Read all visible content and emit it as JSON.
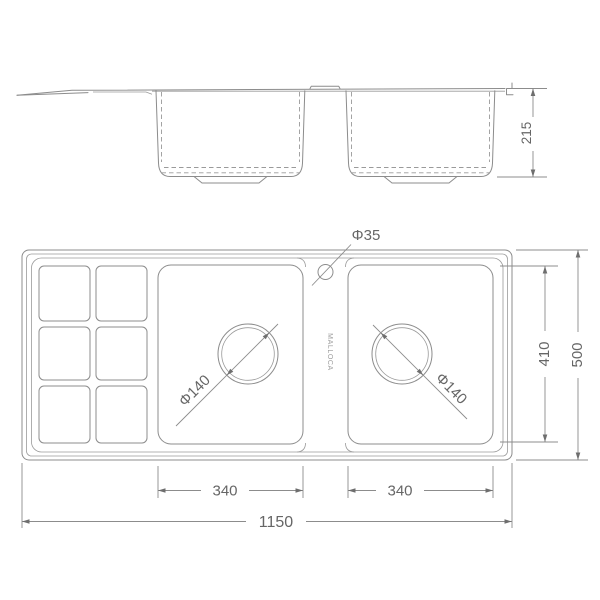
{
  "drawing": {
    "type": "sink-technical-drawing",
    "brand": "MALLOCA",
    "line_color": "#8c8c8c",
    "text_color": "#666666",
    "views": [
      "side-elevation",
      "top-plan"
    ],
    "dimensions_mm": {
      "overall_length": 1150,
      "overall_width": 500,
      "bowl_depth": 215,
      "inner_width": 410,
      "left_bowl_length": 340,
      "right_bowl_length": 340,
      "drain_diameter": 140,
      "faucet_hole_diameter": 35
    }
  },
  "labels": {
    "depth": "215",
    "faucet_hole": "Φ35",
    "brand": "MALLOCA",
    "drain_left": "Φ140",
    "drain_right": "Φ140",
    "inner_width": "410",
    "overall_width": "500",
    "bowl_left": "340",
    "bowl_right": "340",
    "overall_length": "1150"
  }
}
